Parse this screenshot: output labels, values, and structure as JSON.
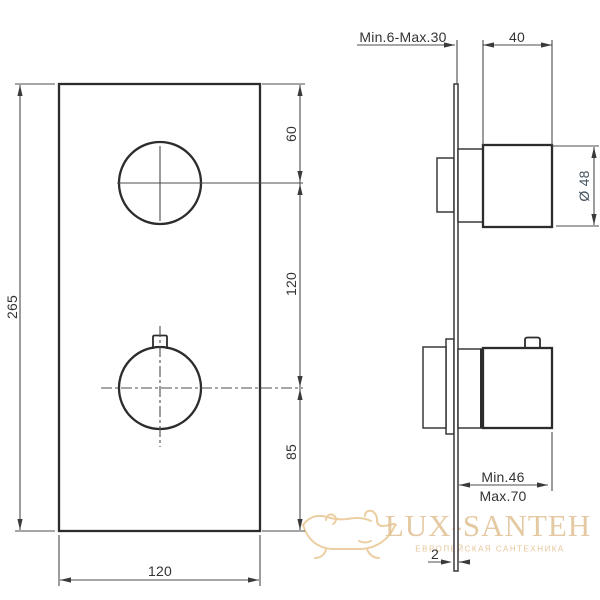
{
  "front_view": {
    "plate_height": "265",
    "plate_width": "120",
    "top_to_upper_handle": "60",
    "handle_spacing": "120",
    "lower_handle_to_bottom": "85"
  },
  "side_view": {
    "installation_depth": "Min.6-Max.30",
    "handle_length": "40",
    "handle_diameter": "Ø 48",
    "projection_min": "Min.46",
    "projection_max": "Max.70",
    "plate_thickness": "2"
  },
  "watermark": {
    "brand": "LUX-SANTEH",
    "tagline": "ЕВРОПЕЙСКАЯ САНТЕХНИКА"
  },
  "colors": {
    "outline": "#2c2c2c",
    "dimension_line": "#4c4c4c",
    "dimension_text": "#333333",
    "diameter_text": "#42525f",
    "watermark_gold": "#e5c08a"
  }
}
